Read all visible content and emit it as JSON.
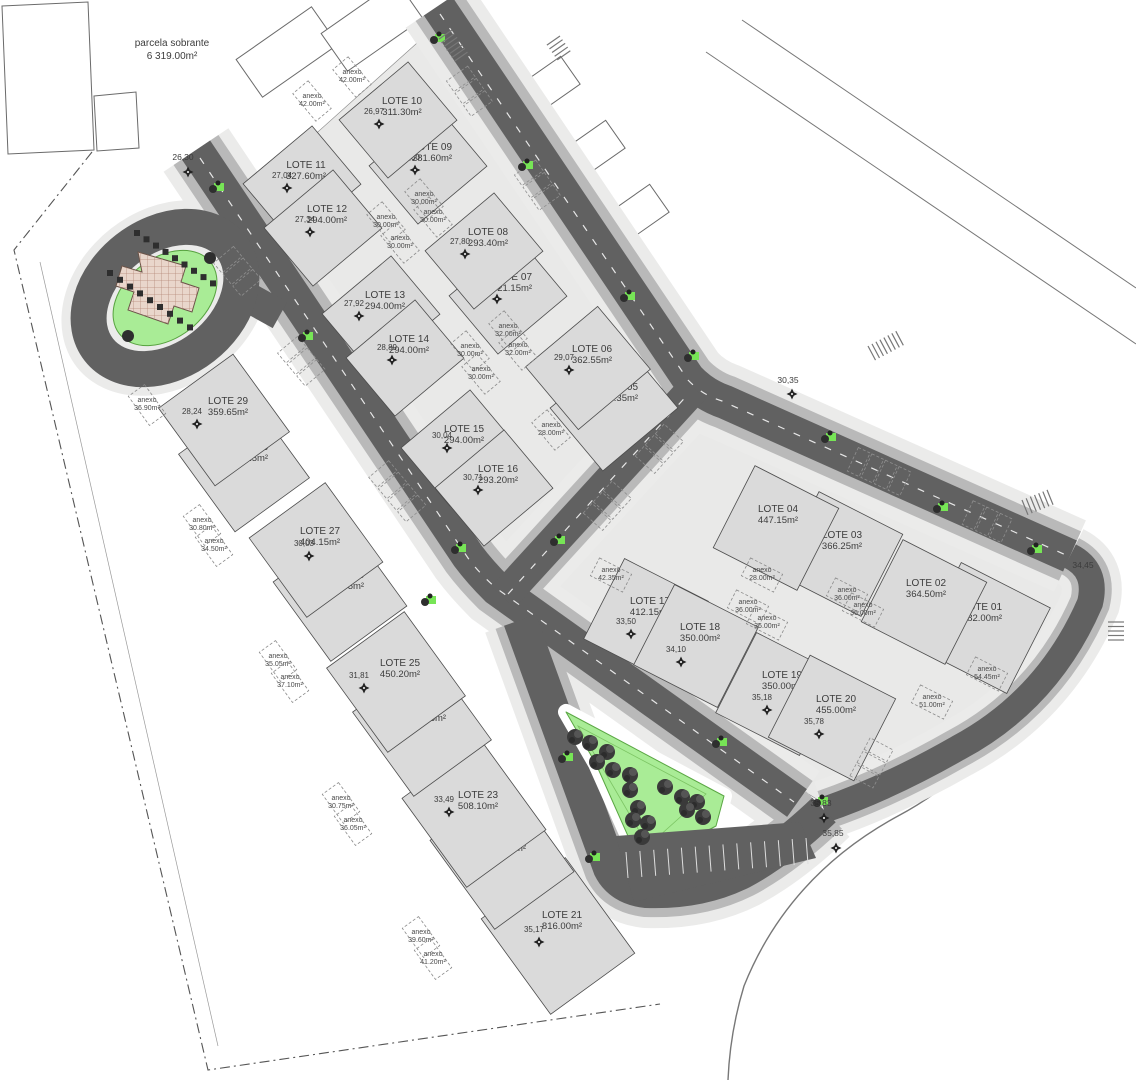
{
  "note": {
    "line1": "parcela sobrante",
    "line2": "6 319.00m²",
    "x": 172,
    "y": 44
  },
  "lots": [
    {
      "id": "01",
      "name": "LOTE 01",
      "area": "482.00m²",
      "x": 982,
      "y": 610
    },
    {
      "id": "02",
      "name": "LOTE 02",
      "area": "364.50m²",
      "x": 926,
      "y": 586
    },
    {
      "id": "03",
      "name": "LOTE 03",
      "area": "366.25m²",
      "x": 842,
      "y": 538
    },
    {
      "id": "04",
      "name": "LOTE 04",
      "area": "447.15m²",
      "x": 778,
      "y": 512
    },
    {
      "id": "05",
      "name": "LOTE 05",
      "area": "416.35m²",
      "width": "29,66",
      "x": 618,
      "y": 390,
      "wx": 588,
      "wy": 398
    },
    {
      "id": "06",
      "name": "LOTE 06",
      "area": "362.55m²",
      "width": "29,07",
      "x": 592,
      "y": 352,
      "wx": 564,
      "wy": 360
    },
    {
      "id": "07",
      "name": "LOTE 07",
      "area": "321.15m²",
      "width": "28,27",
      "x": 512,
      "y": 280,
      "wx": 492,
      "wy": 289
    },
    {
      "id": "08",
      "name": "LOTE 08",
      "area": "293.40m²",
      "width": "27,80",
      "x": 488,
      "y": 235,
      "wx": 460,
      "wy": 244
    },
    {
      "id": "09",
      "name": "LOTE 09",
      "area": "281.60m²",
      "width": "27,30",
      "x": 432,
      "y": 150,
      "wx": 410,
      "wy": 160
    },
    {
      "id": "10",
      "name": "LOTE 10",
      "area": "311.30m²",
      "width": "26,97",
      "x": 402,
      "y": 104,
      "wx": 374,
      "wy": 114
    },
    {
      "id": "11",
      "name": "LOTE 11",
      "area": "327.60m²",
      "width": "27,04",
      "x": 306,
      "y": 168,
      "wx": 282,
      "wy": 178
    },
    {
      "id": "12",
      "name": "LOTE 12",
      "area": "294.00m²",
      "width": "27,34",
      "x": 327,
      "y": 212,
      "wx": 305,
      "wy": 222
    },
    {
      "id": "13",
      "name": "LOTE 13",
      "area": "294.00m²",
      "width": "27,92",
      "x": 385,
      "y": 298,
      "wx": 354,
      "wy": 306
    },
    {
      "id": "14",
      "name": "LOTE 14",
      "area": "294.00m²",
      "width": "28,89",
      "x": 409,
      "y": 342,
      "wx": 387,
      "wy": 350
    },
    {
      "id": "15",
      "name": "LOTE 15",
      "area": "294.00m²",
      "width": "30,04",
      "x": 464,
      "y": 432,
      "wx": 442,
      "wy": 438
    },
    {
      "id": "16",
      "name": "LOTE 16",
      "area": "293.20m²",
      "width": "30,71",
      "x": 498,
      "y": 472,
      "wx": 473,
      "wy": 480
    },
    {
      "id": "17",
      "name": "LOTE 17",
      "area": "412.15m²",
      "width": "33,50",
      "x": 650,
      "y": 604,
      "wx": 626,
      "wy": 624
    },
    {
      "id": "18",
      "name": "LOTE 18",
      "area": "350.00m²",
      "width": "34,10",
      "x": 700,
      "y": 630,
      "wx": 676,
      "wy": 652
    },
    {
      "id": "19",
      "name": "LOTE 19",
      "area": "350.00m²",
      "width": "35,18",
      "x": 782,
      "y": 678,
      "wx": 762,
      "wy": 700
    },
    {
      "id": "20",
      "name": "LOTE 20",
      "area": "455.00m²",
      "width": "35,78",
      "x": 836,
      "y": 702,
      "wx": 814,
      "wy": 724
    },
    {
      "id": "21",
      "name": "LOTE 21",
      "area": "816.00m²",
      "width": "35,17",
      "x": 562,
      "y": 918,
      "wx": 534,
      "wy": 932
    },
    {
      "id": "22",
      "name": "LOTE 22",
      "area": "597.15m²",
      "width": "34,09",
      "x": 506,
      "y": 840,
      "wx": 472,
      "wy": 846
    },
    {
      "id": "23",
      "name": "LOTE 23",
      "area": "508.10m²",
      "width": "33,49",
      "x": 478,
      "y": 798,
      "wx": 444,
      "wy": 802
    },
    {
      "id": "24",
      "name": "LOTE 24",
      "area": "471.35m²",
      "width": "32,41",
      "x": 426,
      "y": 710,
      "wx": 389,
      "wy": 724
    },
    {
      "id": "25",
      "name": "LOTE 25",
      "area": "450.20m²",
      "width": "31,81",
      "x": 400,
      "y": 666,
      "wx": 359,
      "wy": 678
    },
    {
      "id": "26",
      "name": "LOTE 26",
      "area": "436.55m²",
      "width": "30,67",
      "x": 344,
      "y": 578,
      "wx": 306,
      "wy": 592
    },
    {
      "id": "27",
      "name": "LOTE 27",
      "area": "404.15m²",
      "width": "30,03",
      "x": 320,
      "y": 534,
      "wx": 304,
      "wy": 546
    },
    {
      "id": "28",
      "name": "LOTE 28",
      "area": "378.15m²",
      "width": "28,89",
      "x": 248,
      "y": 450,
      "wx": 222,
      "wy": 460
    },
    {
      "id": "29",
      "name": "LOTE 29",
      "area": "359.65m²",
      "width": "28,24",
      "x": 228,
      "y": 404,
      "wx": 192,
      "wy": 414
    }
  ],
  "anexos": [
    {
      "label": "anexo",
      "area": "42.00m²",
      "x": 352,
      "y": 74
    },
    {
      "label": "anexo",
      "area": "42.00m²",
      "x": 312,
      "y": 98
    },
    {
      "label": "anexo",
      "area": "30.00m²",
      "x": 424,
      "y": 196
    },
    {
      "label": "anexo",
      "area": "30.00m²",
      "x": 433,
      "y": 214
    },
    {
      "label": "anexo",
      "area": "30.00m²",
      "x": 386,
      "y": 219
    },
    {
      "label": "anexo",
      "area": "30.00m²",
      "x": 400,
      "y": 240
    },
    {
      "label": "anexo",
      "area": "32.00m²",
      "x": 508,
      "y": 328
    },
    {
      "label": "anexo",
      "area": "32.00m²",
      "x": 518,
      "y": 347
    },
    {
      "label": "anexo",
      "area": "30.00m²",
      "x": 470,
      "y": 348
    },
    {
      "label": "anexo",
      "area": "30.00m²",
      "x": 481,
      "y": 371
    },
    {
      "label": "anexo",
      "area": "28.00m²",
      "x": 551,
      "y": 427
    },
    {
      "label": "anexo",
      "area": "36.90m²",
      "x": 147,
      "y": 402
    },
    {
      "label": "anexo",
      "area": "30.80m²",
      "x": 202,
      "y": 522
    },
    {
      "label": "anexo",
      "area": "34.50m²",
      "x": 214,
      "y": 543
    },
    {
      "label": "anexo",
      "area": "35.05m²",
      "x": 278,
      "y": 658
    },
    {
      "label": "anexo",
      "area": "37.10m²",
      "x": 290,
      "y": 679
    },
    {
      "label": "anexo",
      "area": "30.75m²",
      "x": 341,
      "y": 800
    },
    {
      "label": "anexo",
      "area": "36.05m²",
      "x": 353,
      "y": 822
    },
    {
      "label": "anexo",
      "area": "39.60m²",
      "x": 421,
      "y": 934
    },
    {
      "label": "anexo",
      "area": "41.20m²",
      "x": 433,
      "y": 956
    },
    {
      "label": "anexo",
      "area": "42.35m²",
      "x": 611,
      "y": 572
    },
    {
      "label": "anexo",
      "area": "28.00m²",
      "x": 762,
      "y": 572
    },
    {
      "label": "anexo",
      "area": "36.00m²",
      "x": 748,
      "y": 604
    },
    {
      "label": "anexo",
      "area": "36.00m²",
      "x": 767,
      "y": 620
    },
    {
      "label": "anexo",
      "area": "36.00m²",
      "x": 847,
      "y": 592
    },
    {
      "label": "anexo",
      "area": "36.00m²",
      "x": 863,
      "y": 607
    },
    {
      "label": "anexo",
      "area": "54.45m²",
      "x": 987,
      "y": 671
    },
    {
      "label": "anexo",
      "area": "51.00m²",
      "x": 932,
      "y": 699
    }
  ],
  "dims": [
    {
      "text": "30,35",
      "x": 788,
      "y": 383
    },
    {
      "text": "26,30",
      "x": 183,
      "y": 160
    },
    {
      "text": "34,45",
      "x": 1083,
      "y": 568
    },
    {
      "text": "35,83",
      "x": 821,
      "y": 806
    },
    {
      "text": "35,85",
      "x": 833,
      "y": 836
    }
  ],
  "park_trees": [
    [
      575,
      737
    ],
    [
      590,
      743
    ],
    [
      607,
      752
    ],
    [
      597,
      762
    ],
    [
      613,
      770
    ],
    [
      630,
      775
    ],
    [
      630,
      790
    ],
    [
      665,
      787
    ],
    [
      682,
      797
    ],
    [
      697,
      802
    ],
    [
      687,
      810
    ],
    [
      703,
      817
    ],
    [
      638,
      808
    ],
    [
      633,
      820
    ],
    [
      648,
      823
    ],
    [
      642,
      837
    ]
  ],
  "street_greens": [
    [
      440,
      38
    ],
    [
      528,
      165
    ],
    [
      219,
      187
    ],
    [
      308,
      336
    ],
    [
      431,
      600
    ],
    [
      461,
      548
    ],
    [
      630,
      296
    ],
    [
      694,
      356
    ],
    [
      831,
      437
    ],
    [
      943,
      507
    ],
    [
      1037,
      549
    ],
    [
      560,
      540
    ],
    [
      568,
      757
    ],
    [
      595,
      857
    ],
    [
      722,
      742
    ],
    [
      823,
      801
    ]
  ],
  "colors": {
    "road": "#616161",
    "roadside": "#b9b9b9",
    "pavement": "#ebebea",
    "lot": "#dadada",
    "lot_stroke": "#4c4c4c",
    "block": "#e9e9e8",
    "green": "#a9ec96",
    "green_stroke": "#5aa743",
    "green_bright": "#77e556",
    "tree": "#3a3a3a",
    "building_hatch": "#e9d6cb",
    "hatch_line": "#b5897a",
    "text": "#3c3c3c"
  }
}
